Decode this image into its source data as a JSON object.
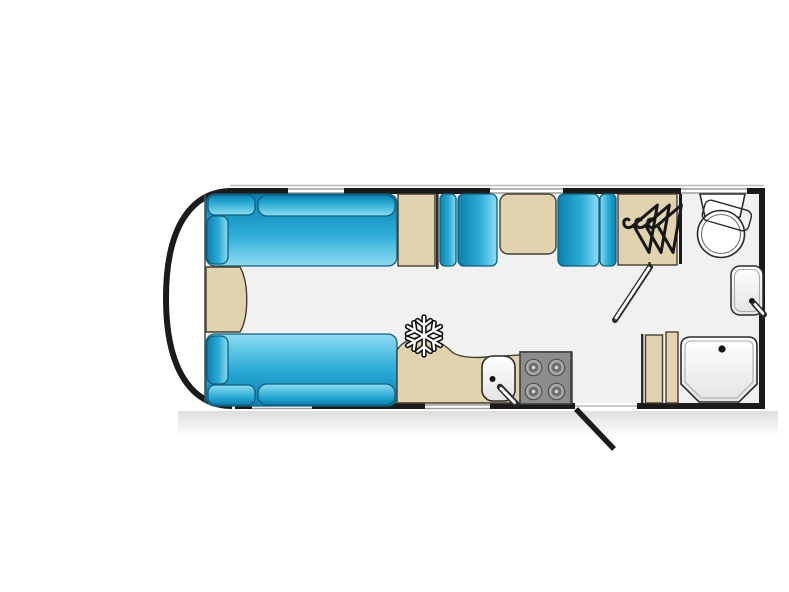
{
  "diagram": {
    "type": "caravan-floorplan",
    "orientation": "side-profile-top-view, hitch end at left",
    "areas": [
      {
        "name": "front-lounge",
        "items": [
          "top-sofa",
          "bottom-sofa",
          "front-chest"
        ]
      },
      {
        "name": "dinette",
        "items": [
          "overhead-cabinet",
          "seat-left",
          "table",
          "seat-right"
        ]
      },
      {
        "name": "kitchen",
        "items": [
          "fridge-snowflake-icon",
          "sink",
          "tap",
          "hob-4-burners",
          "worktop"
        ]
      },
      {
        "name": "entrance",
        "items": [
          "entrance-door-open"
        ]
      },
      {
        "name": "washroom",
        "items": [
          "wardrobe-hangers-icon",
          "washroom-door-open",
          "toilet",
          "basin",
          "shower-tray",
          "shower-cabinet"
        ]
      }
    ],
    "icons": [
      "snowflake-icon",
      "hangers-icon",
      "burner-icon",
      "tap-icon",
      "drain-icon"
    ],
    "windows": {
      "top_wall": 3,
      "bottom_wall": 2
    }
  },
  "colors": {
    "page_bg": "#ffffff",
    "wall": "#1b1b1b",
    "floor": "#f1f1f1",
    "beige": "#e2d3b0",
    "beige_border": "#453e2d",
    "blue_dark": "#0c7fae",
    "blue_mid": "#2aabd6",
    "blue_light": "#8edcf2",
    "blue_edge": "#0e5f7e",
    "hob": "#8d8d8d",
    "hob_border": "#3f3f3f",
    "burner_ring": "#a9a9a9",
    "burner_core": "#6e6e6e",
    "fixture_line": "#2b2b2b",
    "inner_line": "#ababab",
    "window_line": "#9c9c9c",
    "roof_line": "#bababa",
    "tray_shade": "#e4e4e4"
  }
}
